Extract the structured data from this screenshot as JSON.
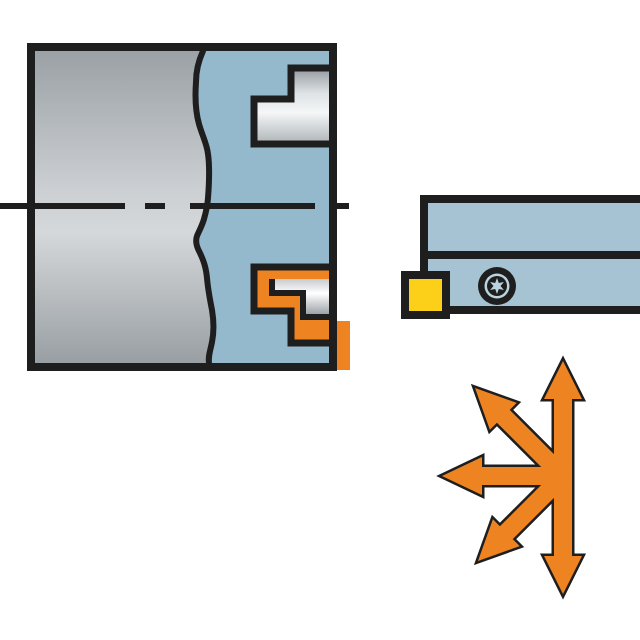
{
  "diagram": {
    "title": "turning-tool-application-illustration",
    "palette": {
      "background": "#ffffff",
      "outline": "#1e1e1e",
      "workpiece_blue": "#94b8cc",
      "holder_blue": "#a6c3d3",
      "orange": "#ee8421",
      "yellow": "#fccf19",
      "screw_ring": "#b9d3df"
    },
    "workpiece": {
      "kind": "cylindrical-part-cross-section",
      "features": [
        "broken-out-wavy-section-line",
        "dash-dot-centerline",
        "machined-step-upper-bore",
        "highlighted-step-lower-bore"
      ],
      "highlight_color": "#ee8421"
    },
    "toolholder": {
      "kind": "lathe-tool-holder-side-view",
      "insert_color": "#fccf19",
      "parts": [
        "shank",
        "clamp-section",
        "square-insert",
        "torx-screw"
      ]
    },
    "arrows": {
      "kind": "feed-direction-arrows",
      "color": "#ee8421",
      "directions": [
        "up",
        "down",
        "left",
        "upper-left",
        "lower-left"
      ]
    }
  }
}
